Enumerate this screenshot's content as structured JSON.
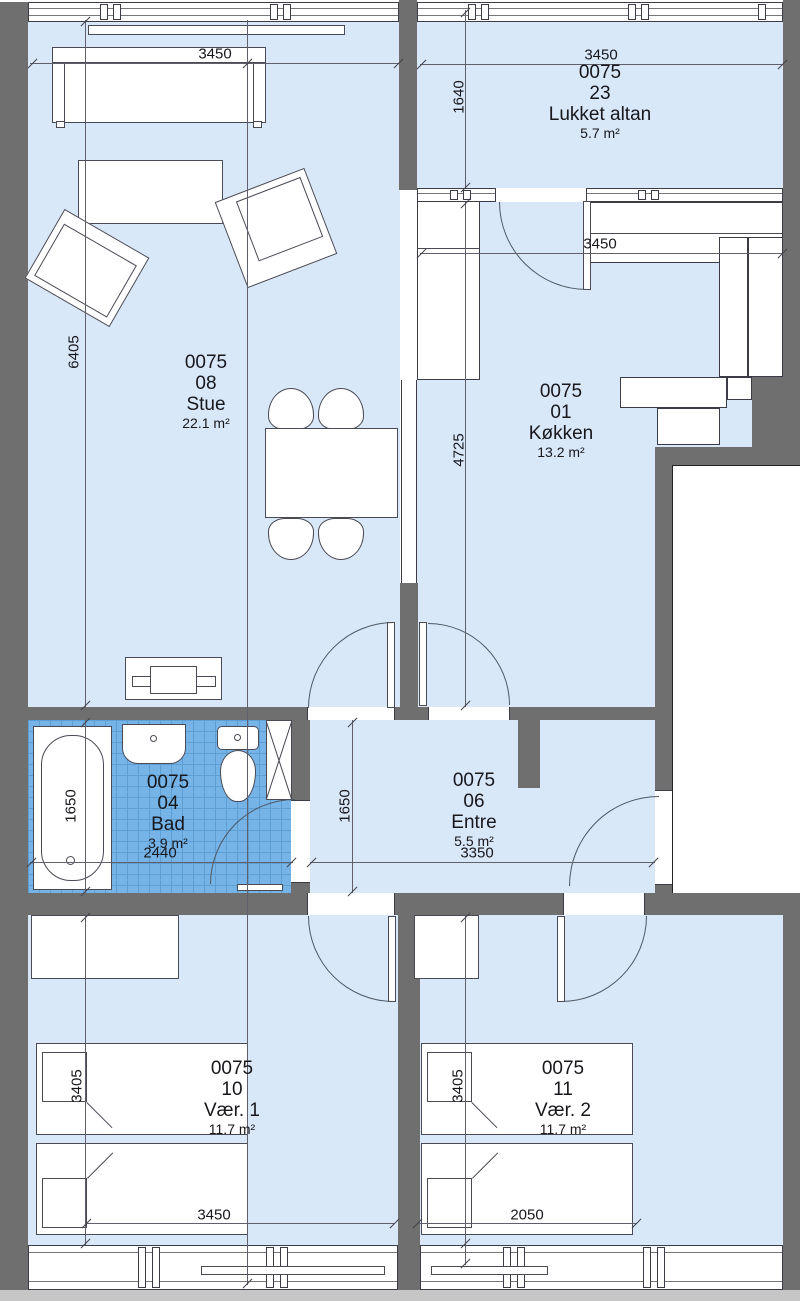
{
  "rooms": [
    {
      "code": "0075",
      "id": "08",
      "name": "Stue",
      "area": "22.1 m²"
    },
    {
      "code": "0075",
      "id": "23",
      "name": "Lukket altan",
      "area": "5.7 m²"
    },
    {
      "code": "0075",
      "id": "01",
      "name": "Køkken",
      "area": "13.2 m²"
    },
    {
      "code": "0075",
      "id": "04",
      "name": "Bad",
      "area": "3.9 m²"
    },
    {
      "code": "0075",
      "id": "06",
      "name": "Entre",
      "area": "5.5 m²"
    },
    {
      "code": "0075",
      "id": "10",
      "name": "Vær. 1",
      "area": "11.7 m²"
    },
    {
      "code": "0075",
      "id": "11",
      "name": "Vær. 2",
      "area": "11.7 m²"
    }
  ],
  "dims": [
    {
      "label": "3450",
      "orientation": "h",
      "measures": "stue width"
    },
    {
      "label": "6405",
      "orientation": "v",
      "measures": "stue height"
    },
    {
      "label": "3450",
      "orientation": "h",
      "measures": "lukket altan width"
    },
    {
      "label": "1640",
      "orientation": "v",
      "measures": "lukket altan depth"
    },
    {
      "label": "3450",
      "orientation": "h",
      "measures": "køkken width"
    },
    {
      "label": "4725",
      "orientation": "v",
      "measures": "køkken height"
    },
    {
      "label": "1650",
      "orientation": "v",
      "measures": "bad height"
    },
    {
      "label": "2440",
      "orientation": "h",
      "measures": "bad width"
    },
    {
      "label": "1650",
      "orientation": "v",
      "measures": "entre height"
    },
    {
      "label": "3350",
      "orientation": "h",
      "measures": "entre width"
    },
    {
      "label": "3405",
      "orientation": "v",
      "measures": "vær. 1 height"
    },
    {
      "label": "3450",
      "orientation": "h",
      "measures": "vær. 1 width"
    },
    {
      "label": "3405",
      "orientation": "v",
      "measures": "vær. 2 height"
    },
    {
      "label": "2050",
      "orientation": "h",
      "measures": "bed length vær. 2"
    }
  ],
  "colors": {
    "room": "#d9e8f9",
    "tile": "#76b4e8",
    "tileline": "#5d9fd3",
    "wall": "#6f6f6f",
    "line": "#3c3c46",
    "slab": "#c6c6c6"
  }
}
